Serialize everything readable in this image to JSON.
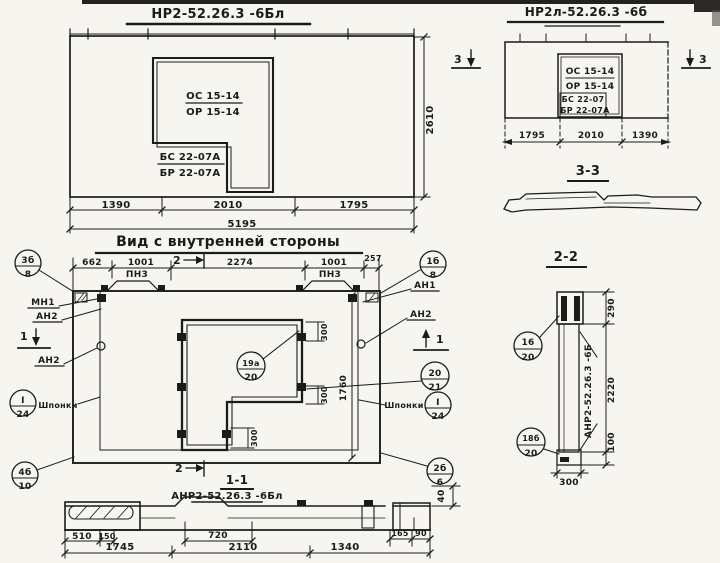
{
  "palette": {
    "ink": "#1b1b18",
    "paper": "#f7f5ef"
  },
  "top_left_elevation": {
    "title": "НР2-52.26.3 -6Бл",
    "opening_top": "ОС 15-14",
    "opening_bottom": "ОР 15-14",
    "panel_top": "БС 22-07А",
    "panel_bottom": "БР 22-07А",
    "dims": [
      "1390",
      "2010",
      "1795"
    ],
    "total": "5195",
    "height": "2610"
  },
  "top_right_elevation": {
    "title": "НР2л-52.26.3 -6б",
    "section_mark": "3",
    "opening_top": "ОС 15-14",
    "opening_bottom": "ОР 15-14",
    "panel_top": "БС 22-07",
    "panel_bottom": "БР 22-07А",
    "dims": [
      "1795",
      "2010",
      "1390"
    ]
  },
  "section_3_3": {
    "title": "3-3"
  },
  "section_2_2": {
    "title": "2-2",
    "marking": "АНР2-52.26.3 -6Б",
    "dim_top": "290",
    "dim_mid": "2220",
    "dim_bottom": "100",
    "dim_width": "300",
    "callout_top": {
      "num": "16",
      "den": "20"
    },
    "callout_bottom": {
      "num": "18б",
      "den": "20"
    }
  },
  "main_view": {
    "title": "Вид с внутренней стороны",
    "top_dims": [
      "662",
      "1001",
      "2274",
      "1001",
      "257"
    ],
    "embed_label": "ПН3",
    "label_mn1": "МН1",
    "label_an2": "АН2",
    "label_an1": "АН1",
    "label_keys": "Шпонки",
    "dim_opening": "300",
    "dim_height": "1760",
    "mark_1": "1",
    "mark_2": "2",
    "callout_top_left": {
      "num": "3б",
      "den": "8"
    },
    "callout_top_right": {
      "num": "1б",
      "den": "8"
    },
    "callout_bottom_left": {
      "num": "4б",
      "den": "10"
    },
    "callout_bottom_right": {
      "num": "2б",
      "den": "6"
    },
    "callout_opening": {
      "num": "19а",
      "den": "20"
    },
    "callout_right": {
      "num": "20",
      "den": "21"
    },
    "callout_key": {
      "num": "I",
      "den": "24"
    }
  },
  "section_1_1": {
    "title": "1-1",
    "marking": "АНР2-52.26.3 -6Бл",
    "dims_small": [
      "510",
      "150",
      "720",
      "165",
      "90"
    ],
    "dims_main": [
      "1745",
      "2110",
      "1340"
    ],
    "dim_thickness": "40"
  }
}
